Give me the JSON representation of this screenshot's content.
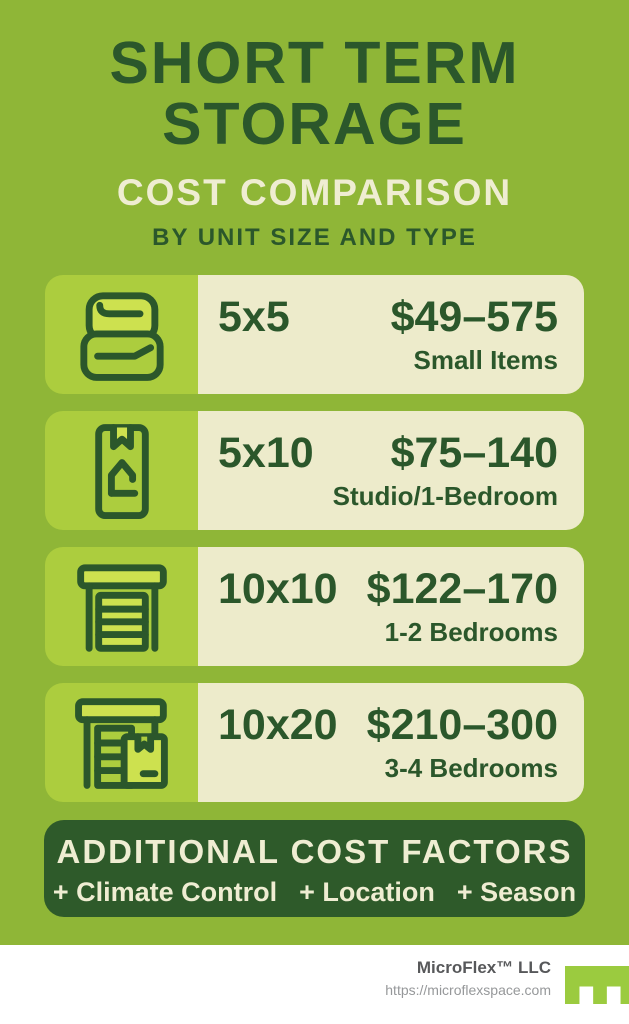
{
  "header": {
    "title_line1": "SHORT TERM",
    "title_line2": "STORAGE",
    "subtitle": "COST COMPARISON",
    "tagline": "BY UNIT SIZE AND TYPE"
  },
  "rows": [
    {
      "size": "5x5",
      "price": "$49–575",
      "desc": "Small Items",
      "icon": "folded-linens-icon"
    },
    {
      "size": "5x10",
      "price": "$75–140",
      "desc": "Studio/1-Bedroom",
      "icon": "moving-box-icon"
    },
    {
      "size": "10x10",
      "price": "$122–170",
      "desc": "1-2 Bedrooms",
      "icon": "garage-door-icon"
    },
    {
      "size": "10x20",
      "price": "$210–300",
      "desc": "3-4 Bedrooms",
      "icon": "storage-unit-box-icon"
    }
  ],
  "factors": {
    "title": "ADDITIONAL COST FACTORS",
    "items": [
      "+ Climate Control",
      "+ Location",
      "+ Season"
    ]
  },
  "footer": {
    "company": "MicroFlex™ LLC",
    "url": "https://microflexspace.com",
    "logo": "microflex-logo"
  },
  "colors": {
    "background": "#8FB637",
    "icon_tile": "#ACCD3E",
    "icon_highlight": "#CDE14F",
    "panel_cream": "#EDEBCB",
    "dark_green": "#2B572B",
    "factors_box": "#2E5A2A",
    "cream_text": "#EFEDD2",
    "logo_green": "#9BCB3F"
  },
  "chart_data": {
    "type": "table",
    "title": "Short Term Storage Cost Comparison by Unit Size and Type",
    "columns": [
      "Unit Size",
      "Price Range",
      "Typical Use"
    ],
    "rows": [
      [
        "5x5",
        "$49–575",
        "Small Items"
      ],
      [
        "5x10",
        "$75–140",
        "Studio/1-Bedroom"
      ],
      [
        "10x10",
        "$122–170",
        "1-2 Bedrooms"
      ],
      [
        "10x20",
        "$210–300",
        "3-4 Bedrooms"
      ]
    ],
    "notes": "Additional cost factors: Climate Control, Location, Season"
  }
}
